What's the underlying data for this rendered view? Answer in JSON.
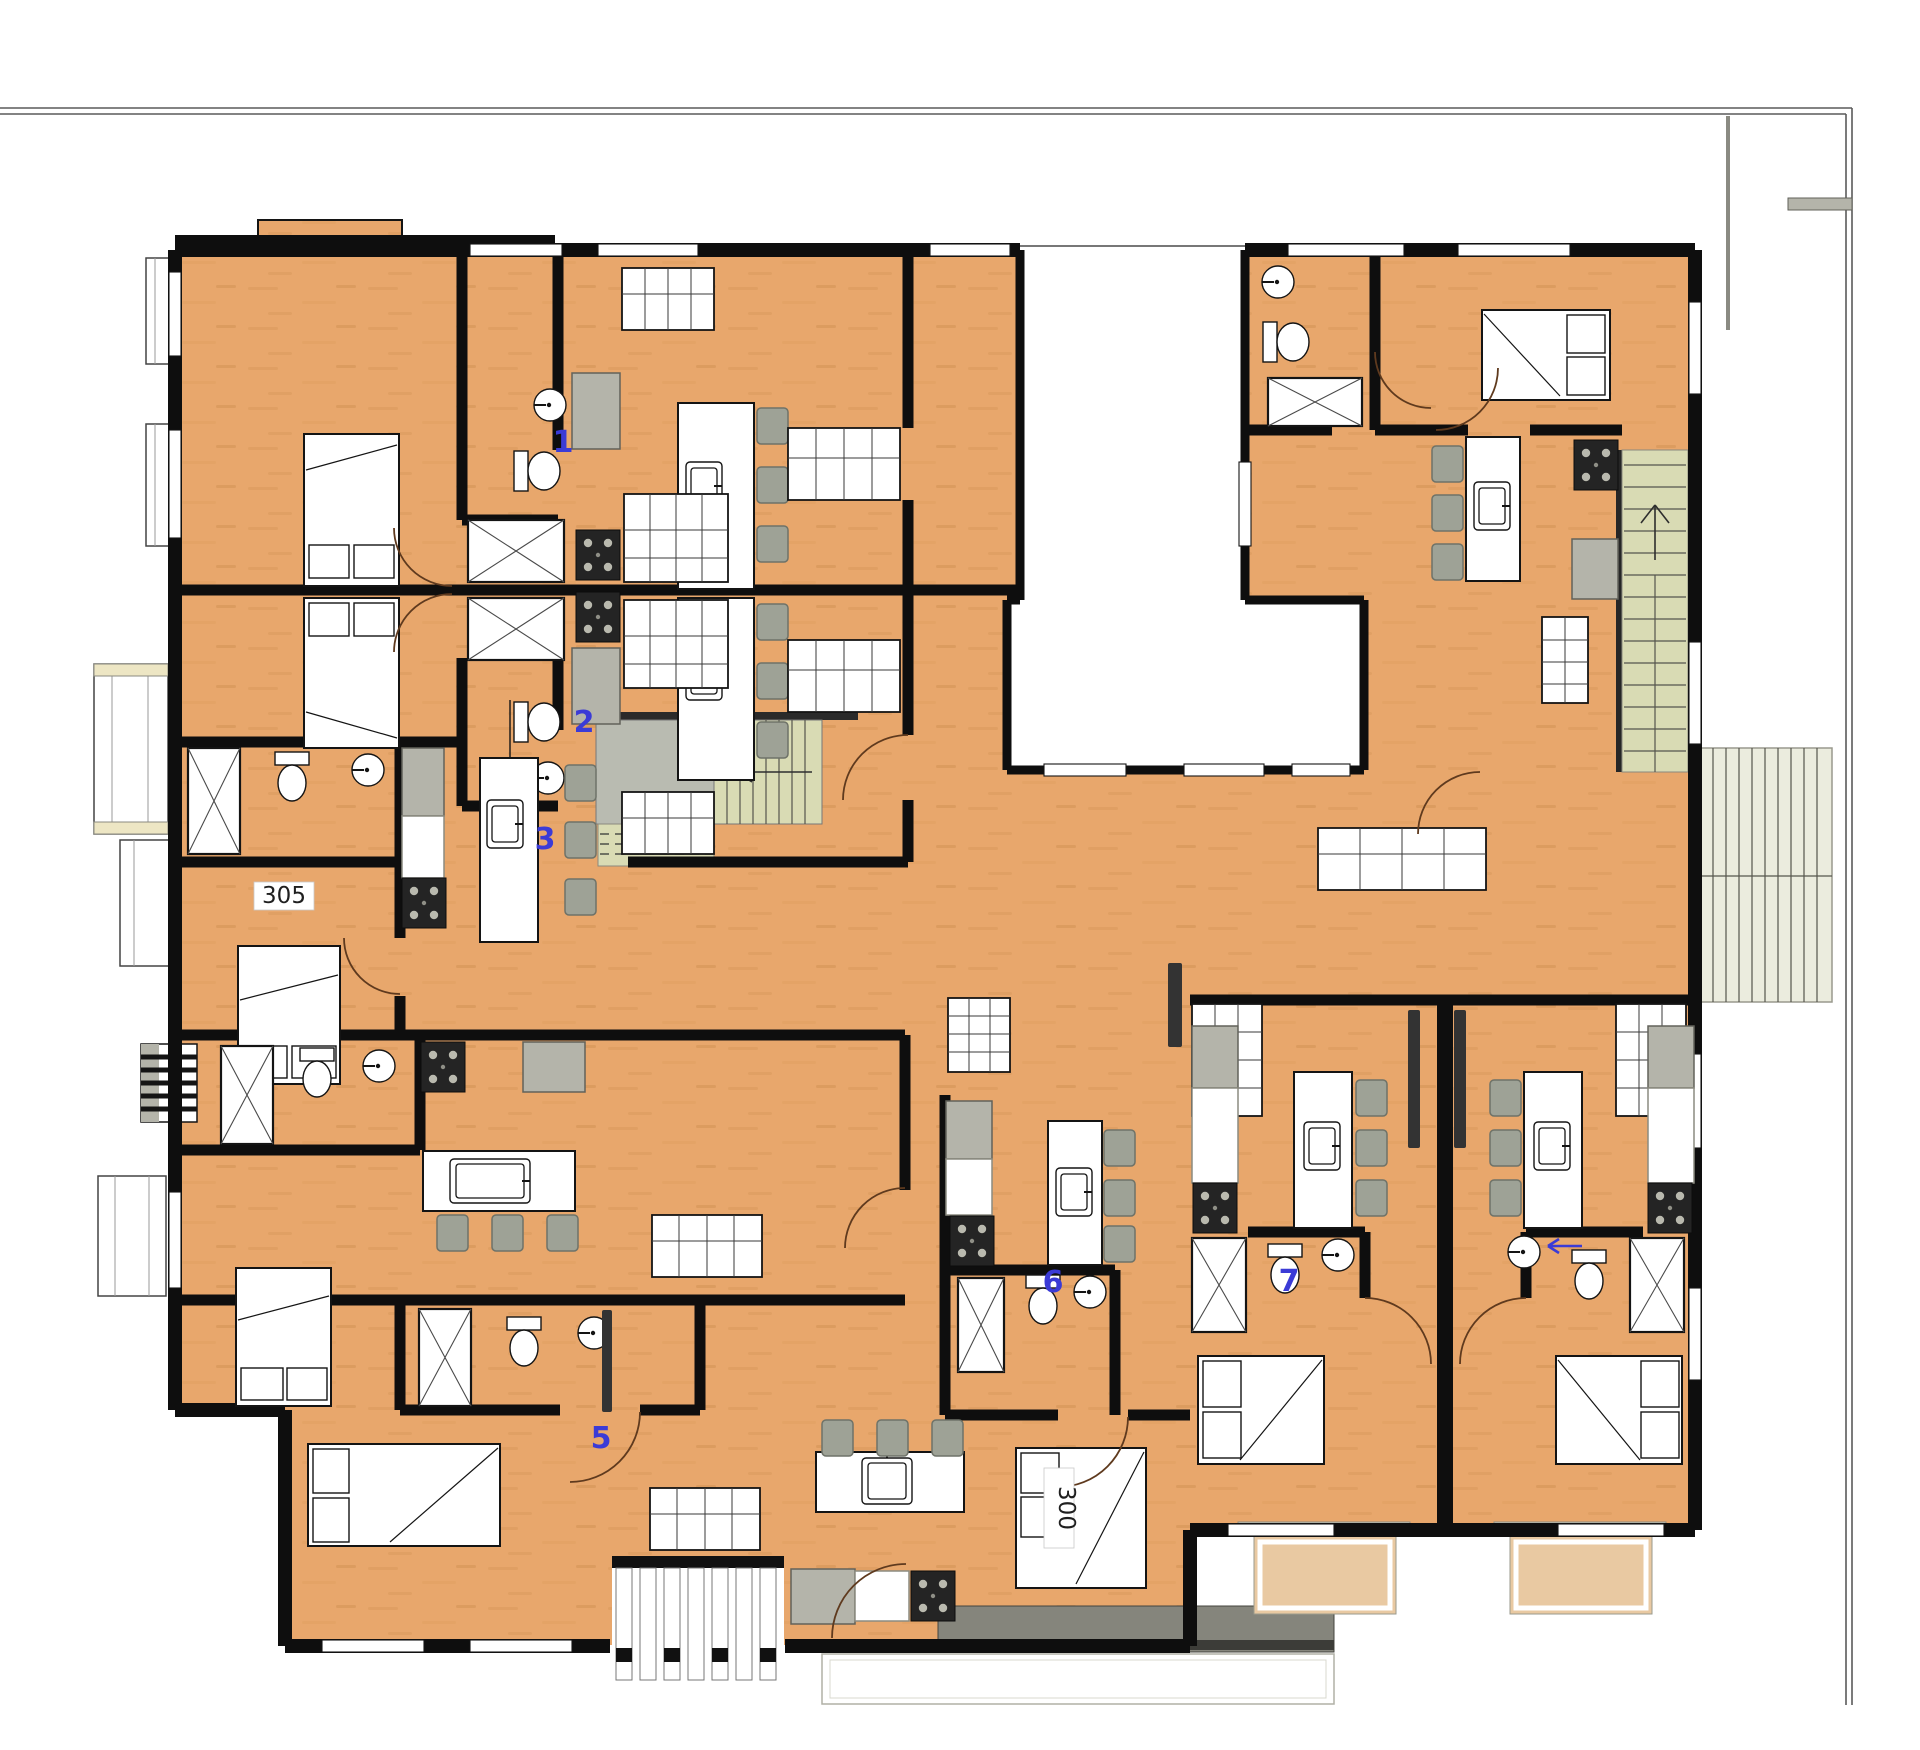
{
  "plan": {
    "markers": [
      {
        "label": "1"
      },
      {
        "label": "2"
      },
      {
        "label": "3"
      },
      {
        "label": "5"
      },
      {
        "label": "6"
      },
      {
        "label": "7"
      }
    ],
    "room_numbers": [
      {
        "label": "305"
      },
      {
        "label": "300"
      }
    ],
    "colors": {
      "floor_wood": "#E8A76C",
      "wall_black": "#0E0E0E",
      "appliance_gray": "#B4B4AA",
      "stair_green": "#D9DBB4",
      "marker_blue": "#3B3BD6",
      "walkway_gray": "#85857C",
      "balcony_tan": "#E9C9A2",
      "boundary_line": "#5A5A5A"
    },
    "fixture_types": [
      "bed",
      "toilet",
      "round-sink",
      "kitchen-island",
      "island-sink",
      "bar-stool",
      "stove",
      "refrigerator",
      "counter",
      "shower-washer-box",
      "sofa",
      "shelving",
      "tv",
      "staircase",
      "deck",
      "balcony",
      "walkway",
      "door-arc",
      "window"
    ]
  }
}
